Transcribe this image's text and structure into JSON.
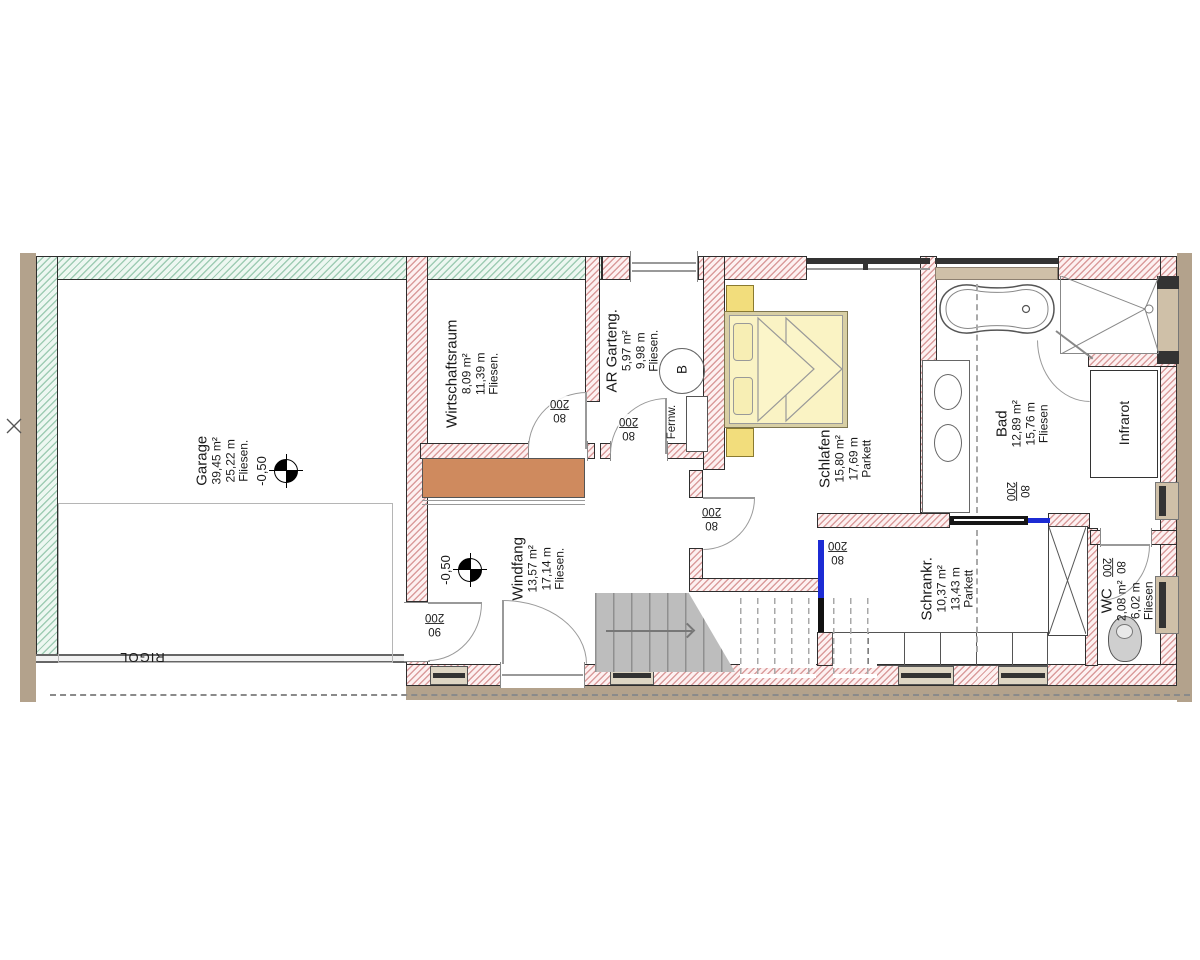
{
  "rooms": {
    "garage": {
      "name": "Garage",
      "area": "39,45 m²",
      "perimeter": "25,22 m",
      "floor": "Fliesen."
    },
    "wirtschaftsraum": {
      "name": "Wirtschaftsraum",
      "area": "8,09 m²",
      "perimeter": "11,39 m",
      "floor": "Fliesen."
    },
    "ar_garteng": {
      "name": "AR Garteng.",
      "area": "5,97 m²",
      "perimeter": "9,98 m",
      "floor": "Fliesen."
    },
    "schlafen": {
      "name": "Schlafen",
      "area": "15,80 m²",
      "perimeter": "17,69 m",
      "floor": "Parkett"
    },
    "bad": {
      "name": "Bad",
      "area": "12,89 m²",
      "perimeter": "15,76 m",
      "floor": "Fliesen"
    },
    "windfang": {
      "name": "Windfang",
      "area": "13,57 m²",
      "perimeter": "17,14 m",
      "floor": "Fliesen."
    },
    "schrankraum": {
      "name": "Schrankr.",
      "area": "10,37 m²",
      "perimeter": "13,43 m",
      "floor": "Parkett"
    },
    "wc": {
      "name": "WC",
      "area": "2,08 m²",
      "perimeter": "6,02 m",
      "floor": "Fliesen"
    }
  },
  "annotations": {
    "rigol": "RIGOL",
    "fernwaerme": "Fernw.",
    "boiler": "B",
    "infrarot": "Infrarot",
    "garage_level": "-0,50",
    "windfang_level": "-0,50"
  },
  "doors": [
    {
      "location": "wirtschaftsraum",
      "width": "80",
      "height": "200"
    },
    {
      "location": "ar-garteng",
      "width": "80",
      "height": "200"
    },
    {
      "location": "schlafen",
      "width": "80",
      "height": "200"
    },
    {
      "location": "schrankraum-schiebetuer",
      "width": "80",
      "height": "200"
    },
    {
      "location": "bad-schiebetuer",
      "width": "80",
      "height": "200"
    },
    {
      "location": "wc",
      "width": "80",
      "height": "200"
    },
    {
      "location": "garage-windfang",
      "width": "90",
      "height": "200"
    }
  ],
  "colors": {
    "wall_hatch_pink": "#da9c9c",
    "wall_hatch_green": "#9fccb4",
    "exterior_strip_tan": "#b3a28c",
    "furniture_yellow": "#faf3c4",
    "sideboard_orange": "#cf8a5e",
    "sliding_door_blue": "#1c2bd4",
    "stairs_gray": "#bdbdbd"
  }
}
